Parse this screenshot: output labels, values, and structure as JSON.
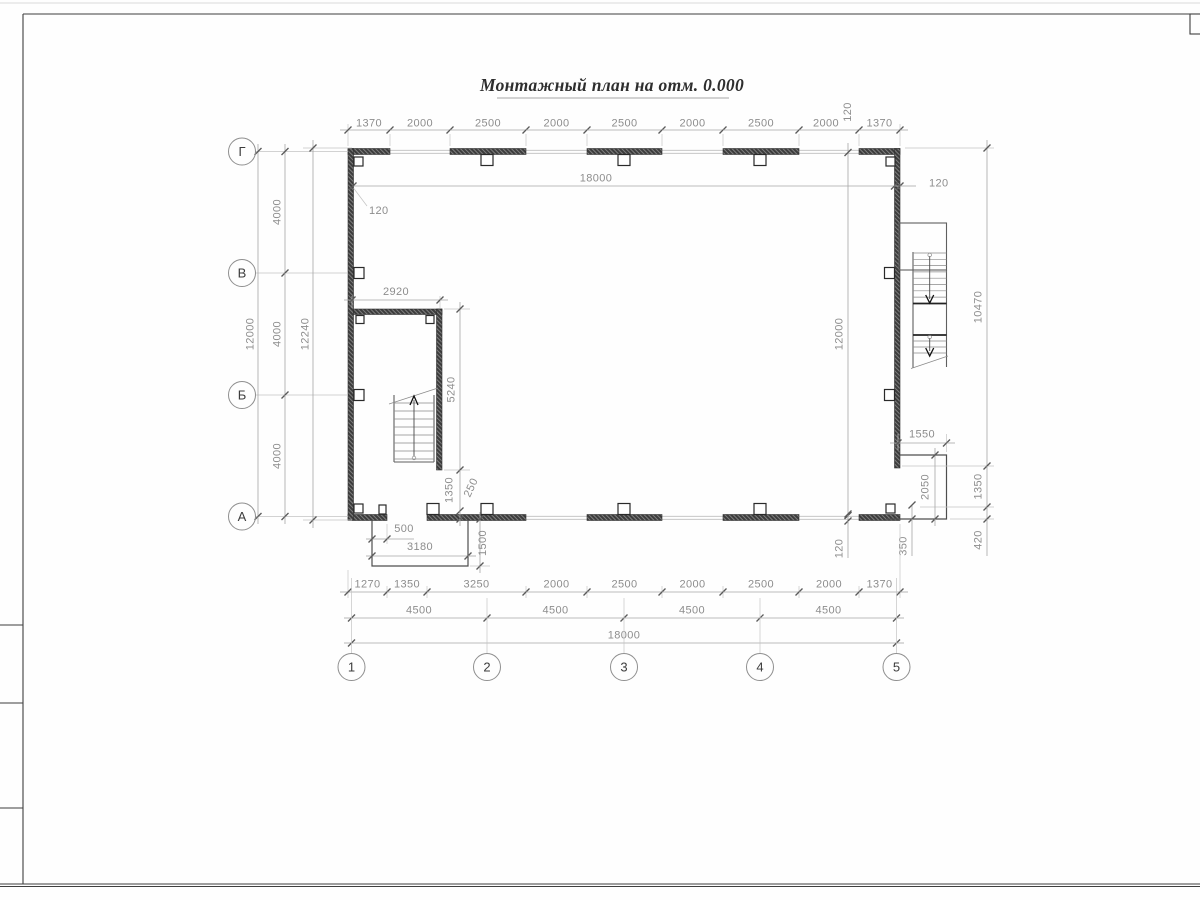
{
  "title": "Монтажный план на отм. 0.000",
  "axes": {
    "cols": [
      "1",
      "2",
      "3",
      "4",
      "5"
    ],
    "rows": [
      "Г",
      "В",
      "Б",
      "А"
    ]
  },
  "dims": {
    "top_chain": [
      "1370",
      "2000",
      "2500",
      "2000",
      "2500",
      "2000",
      "2500",
      "2000",
      "1370"
    ],
    "top_offset_120": "120",
    "inner_width": "18000",
    "wall_thickness_left": "120",
    "wall_thickness_right": "120",
    "left_bays": [
      "4000",
      "4000",
      "4000"
    ],
    "left_total": "12000",
    "left_outer_total": "12240",
    "inner_height": "12000",
    "right_chain": [
      "10470",
      "1350",
      "420"
    ],
    "stair_enclosure_width": "2920",
    "stair_enclosure_height": "5240",
    "stair_offset_1350": "1350",
    "stair_offset_250": "250",
    "porch_left_offset_500": "500",
    "porch_left_width_3180": "3180",
    "porch_left_depth_1500": "1500",
    "porch_right_width_1550": "1550",
    "porch_right_height_2050": "2050",
    "bottom_offset_120": "120",
    "bottom_offset_350": "350",
    "bottom_chain1": [
      "1270",
      "1350",
      "3250",
      "2000",
      "2500",
      "2000",
      "2500",
      "2000",
      "1370"
    ],
    "bottom_chain2": [
      "4500",
      "4500",
      "4500",
      "4500"
    ],
    "bottom_total": "18000"
  }
}
